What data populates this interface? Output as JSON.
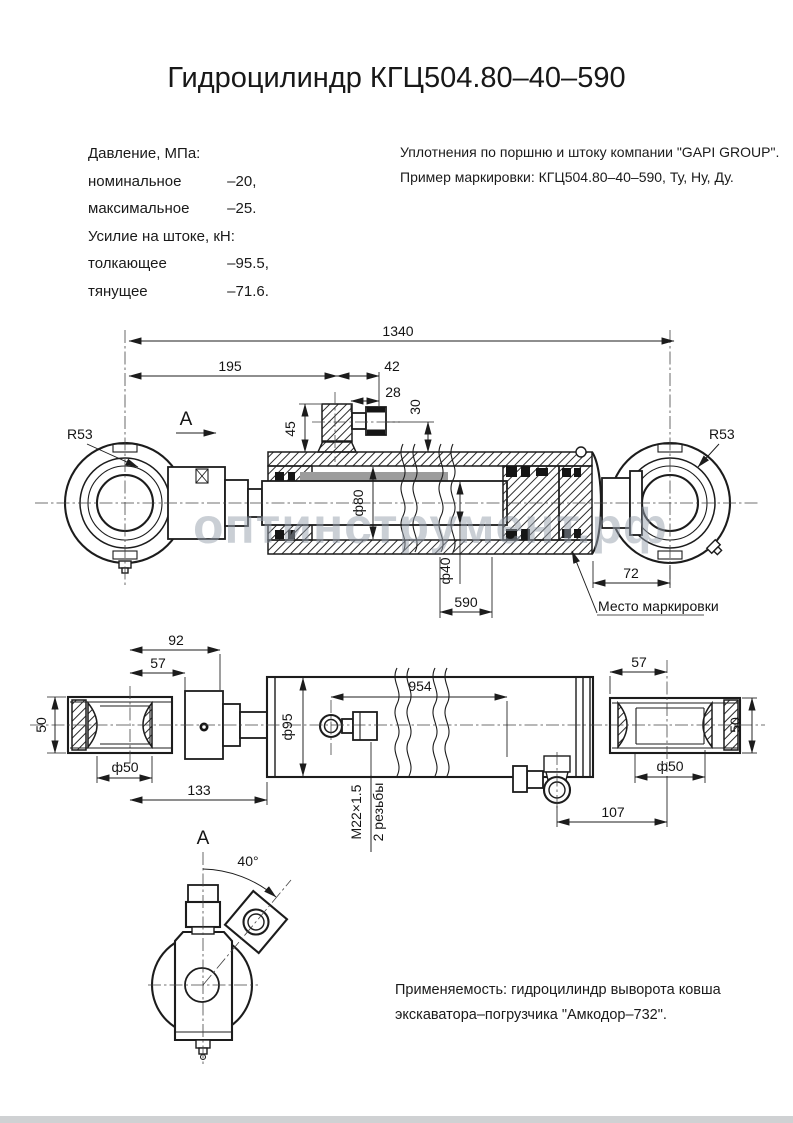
{
  "title": "Гидроцилиндр КГЦ504.80–40–590",
  "specs": {
    "pressure_header": "Давление, МПа:",
    "pressure_rows": [
      {
        "label": "номинальное",
        "value": "–20,"
      },
      {
        "label": "максимальное",
        "value": "–25."
      }
    ],
    "force_header": "Усилие на штоке, кН:",
    "force_rows": [
      {
        "label": "толкающее",
        "value": "–95.5,"
      },
      {
        "label": "тянущее",
        "value": "–71.6."
      }
    ]
  },
  "notes": {
    "line1": "Уплотнения по поршню и штоку компании \"GAPI GROUP\".",
    "line2": "Пример маркировки: КГЦ504.80–40–590, Ту, Ну, Ду."
  },
  "application": {
    "line1": "Применяемость: гидроцилиндр  выворота ковша",
    "line2": "экскаватора–погрузчика \"Амкодор–732\"."
  },
  "watermark": "оптинструмент.рф",
  "main_view": {
    "view_label": "A",
    "dim_overall": "1340",
    "dim_195": "195",
    "dim_42": "42",
    "dim_28": "28",
    "dim_30": "30",
    "dim_45": "45",
    "radius_left": "R53",
    "radius_right": "R53",
    "dia_bore": "ф80",
    "dia_rod": "ф40",
    "dim_590": "590",
    "dim_72": "72",
    "marking_note": "Место маркировки"
  },
  "side_view": {
    "dim_92": "92",
    "dim_57_left": "57",
    "dim_50_left": "50",
    "dia_50_left": "ф50",
    "dim_133": "133",
    "dia_95": "ф95",
    "thread_size": "М22×1.5",
    "thread_count": "2 резьбы",
    "dim_954": "954",
    "dim_57_right": "57",
    "dim_50_right": "50",
    "dia_50_right": "ф50",
    "dim_107": "107"
  },
  "view_a": {
    "label": "A",
    "angle": "40°"
  },
  "colors": {
    "line": "#1c1c1c",
    "watermark": "#97a0ad"
  }
}
